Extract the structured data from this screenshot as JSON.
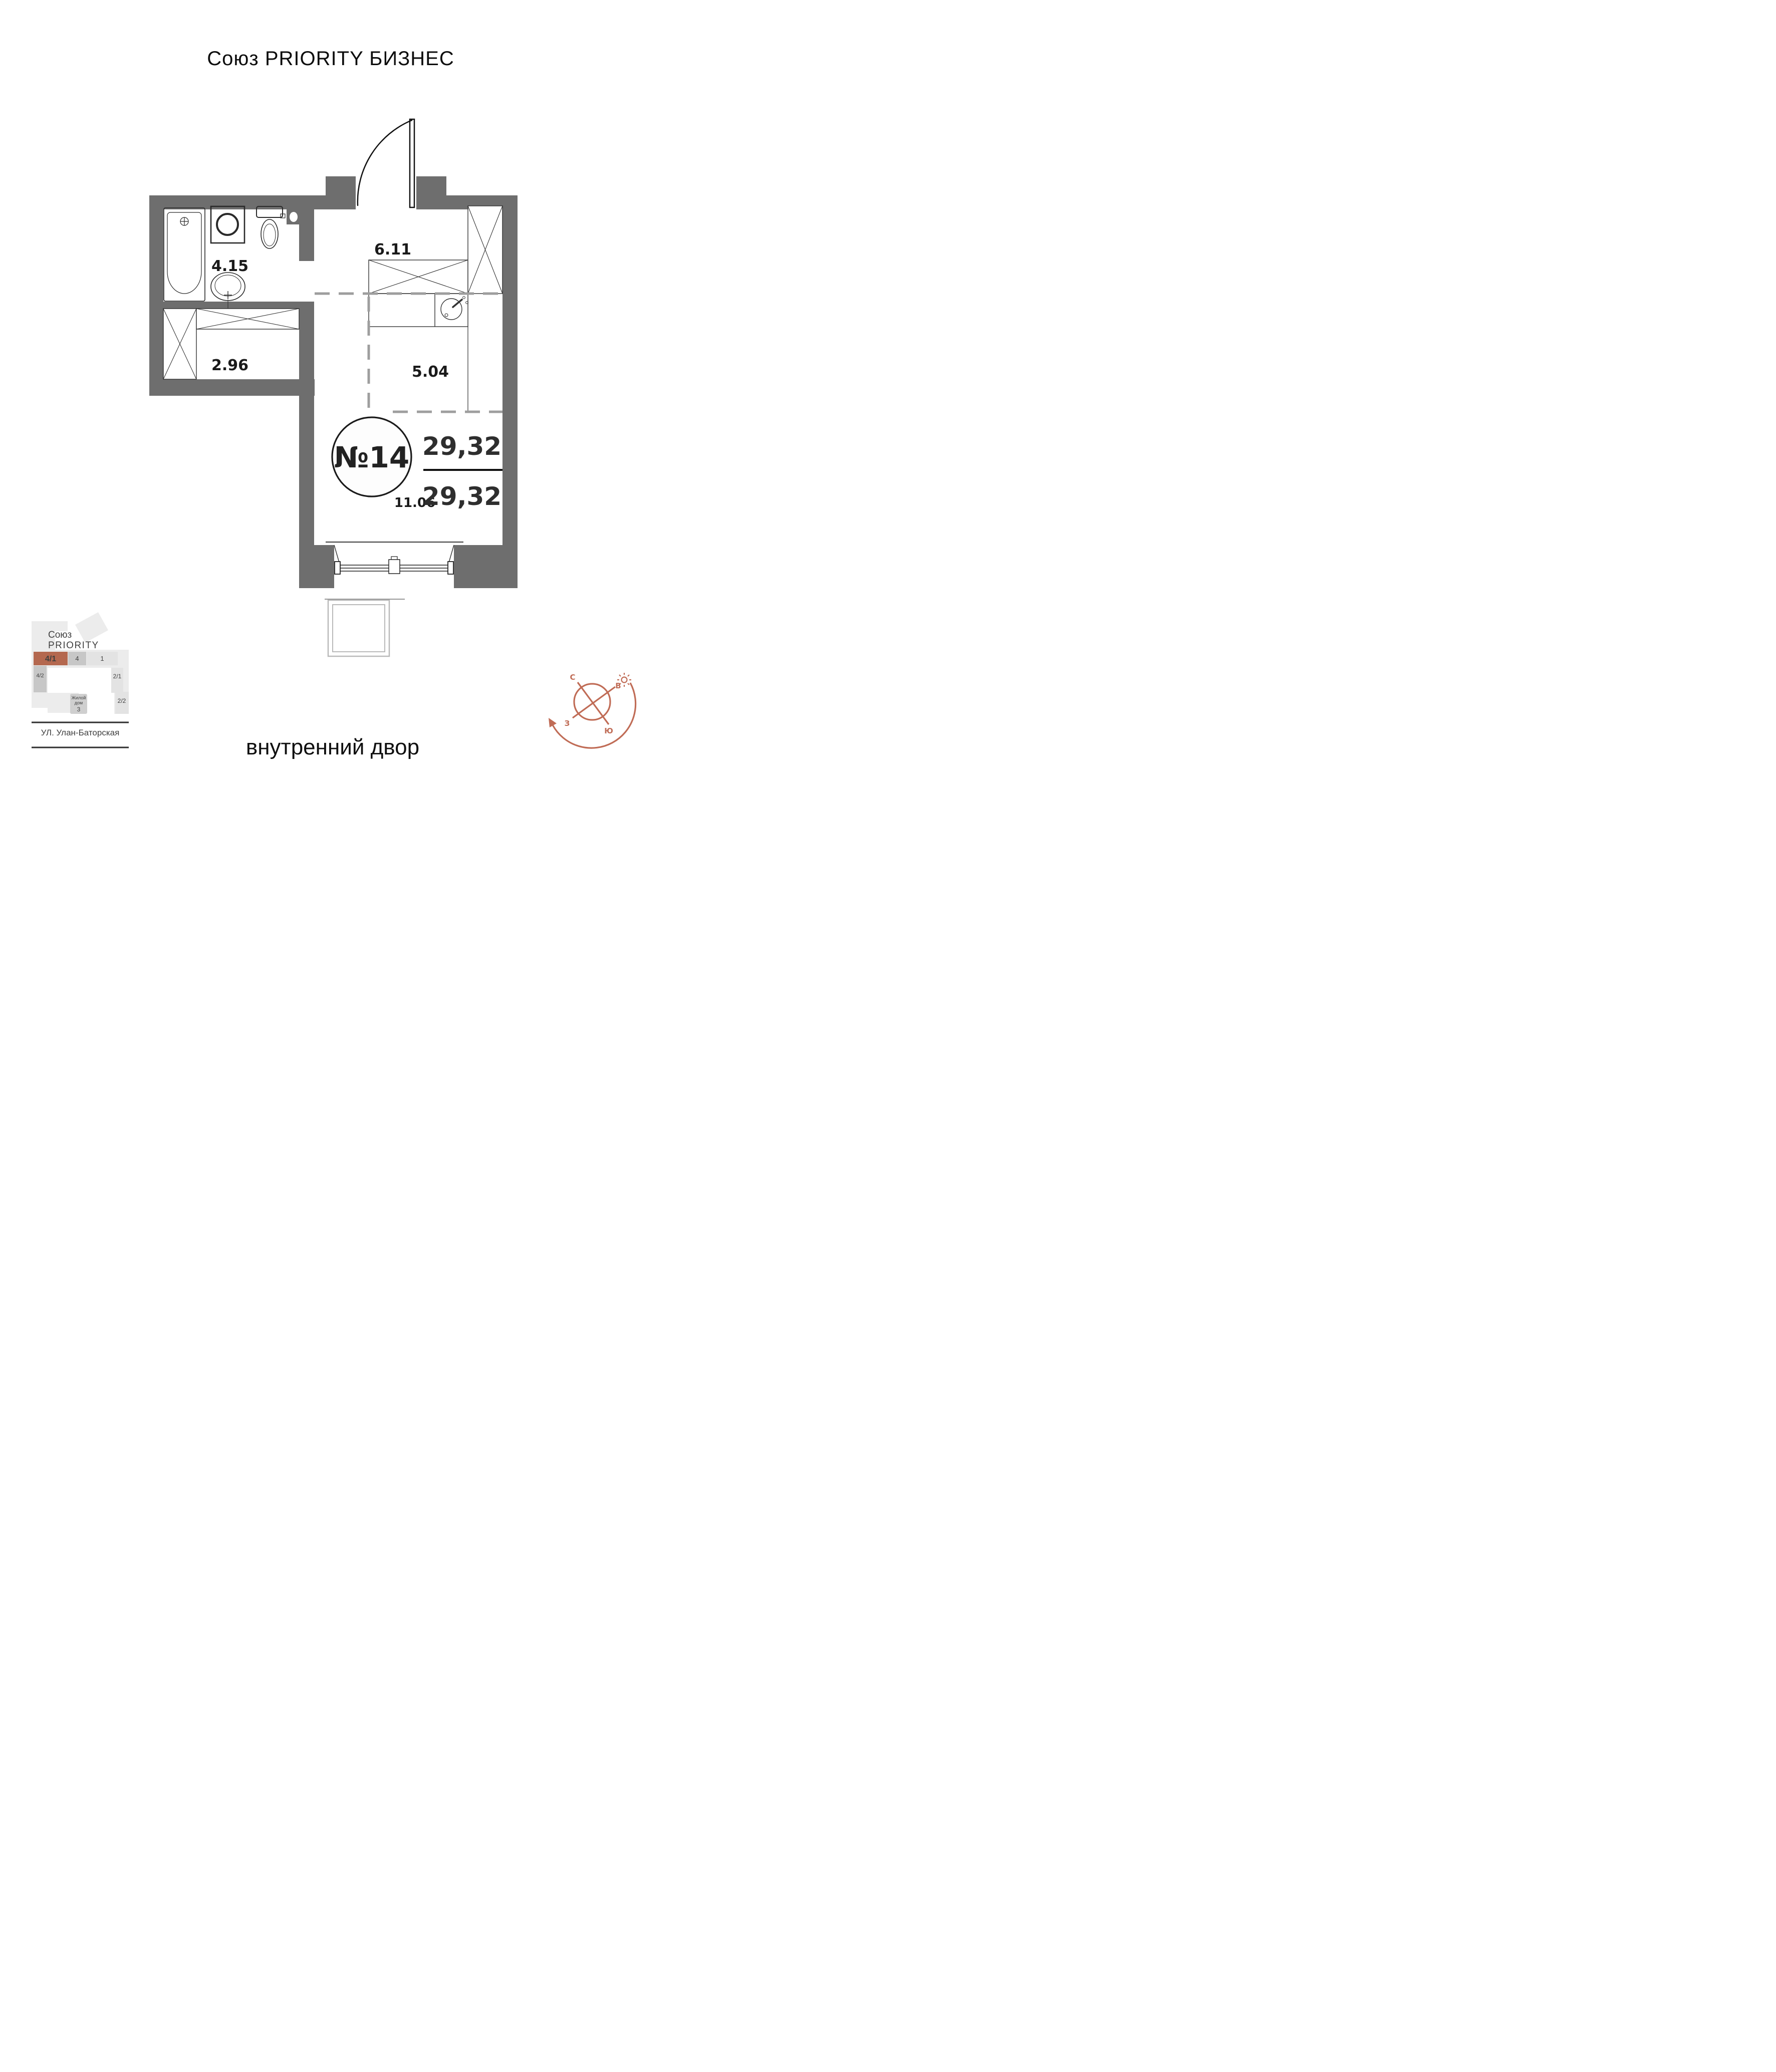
{
  "title": "Союз PRIORITY БИЗНЕС",
  "apartment": {
    "number": "№14",
    "area_total": "29,32",
    "area_living": "29,32"
  },
  "rooms": {
    "bathroom": "4.15",
    "hallway": "6.11",
    "closet": "2.96",
    "kitchen": "5.04",
    "living": "11.06"
  },
  "site_plan": {
    "project_line1": "Союз",
    "project_line2": "PRIORITY",
    "blocks": [
      {
        "label": "4/1",
        "highlighted": true
      },
      {
        "label": "4",
        "highlighted": false
      },
      {
        "label": "1",
        "highlighted": false
      },
      {
        "label": "4/2",
        "highlighted": false
      },
      {
        "label": "2/1",
        "highlighted": false
      },
      {
        "label": "2/2",
        "highlighted": false
      }
    ],
    "house": {
      "line1": "Жилой",
      "line2": "дом",
      "line3": "3"
    },
    "street": "УЛ. Улан-Баторская"
  },
  "footer": {
    "courtyard": "внутренний двор"
  },
  "compass": {
    "north": "С",
    "east": "В",
    "west": "З",
    "south": "Ю"
  },
  "colors": {
    "wall": "#6E6E6E",
    "accent": "#C06C56",
    "site_accent": "#B4684F",
    "dashed": "#9E9E9E",
    "balcony": "#B9B9B9",
    "site_ring": "#ECECEC",
    "site_block_mid": "#C7C7C7",
    "site_block_light": "#E3E3E3"
  }
}
